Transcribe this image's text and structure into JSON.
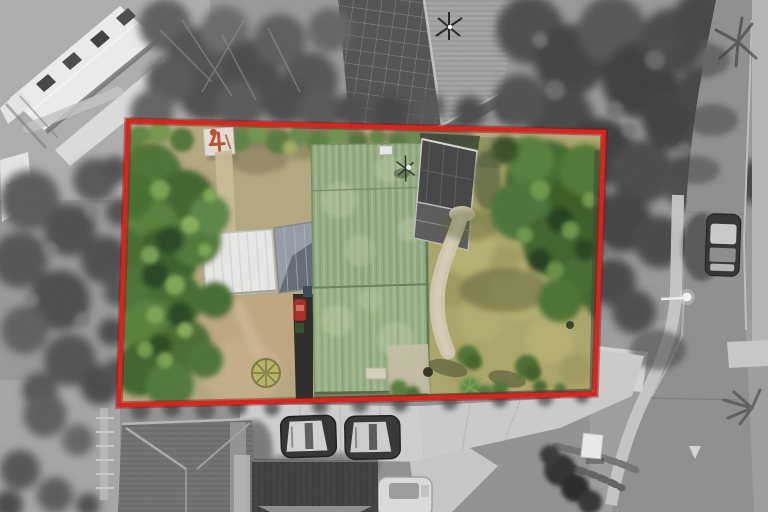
{
  "image": {
    "kind": "aerial-property-photograph",
    "width_px": 768,
    "height_px": 512,
    "style": "drone top-down photo; property inside red outline shown in colour, all surroundings desaturated to greyscale"
  },
  "boundary": {
    "color": "#e2150f",
    "glow_color": "#7d0b07",
    "points": "128,121 604,132 595,394 119,405"
  },
  "palette": {
    "house_roof_green": "#8ea97b",
    "house_roof_lower": "#93b07d",
    "roof_streak_light": "#aebf9a",
    "lawn_dry_tan": "#b2a67c",
    "lawn_sunlit": "#a9a465",
    "tree_green": "#47702f",
    "tree_green_dark": "#24401a",
    "tree_green_light": "#7fa852",
    "path_concrete": "#cfc5aa",
    "road_grey": "#8c8c8c",
    "driveway_concrete": "#cecece",
    "white_roof": "#ededed",
    "dark_roof": "#3a3a3a",
    "rust_red": "#b0502e"
  },
  "landmarks": {
    "outlined_lot": "residential section outlined in red",
    "main_house": "house with weathered green corrugated roof and TV aerial",
    "garage": "white flat-roofed garage",
    "carport": "grey carport between garage and house",
    "garden_shed": "small shed with rust-stained (4-shaped) roof marks",
    "shade_house": "dark mesh shade house beside the house",
    "garden_path": "concrete path curving from shade house along the house",
    "circular_garden": "round wheel-shaped garden bed",
    "left_trees": "dense green trees along left of section",
    "right_tree": "large tree in right corner of rear lawn",
    "street": "street on right with kerbs, footpath and give-way marking",
    "parked_car_street": "car parked on street",
    "street_lamp": "street lamp over road",
    "driveway": "shared concrete driveway along bottom",
    "parked_cars_driveway": "two dark cars and one white car parked off driveway",
    "neighbour_houses": "surrounding greyscale houses: white townhouse roofs top-left, tiled roof top-centre, hip roof bottom-left, dark roof bottom-centre",
    "grey_trees": "greyscale tree masses top-centre, top-right conifers and left edge"
  }
}
